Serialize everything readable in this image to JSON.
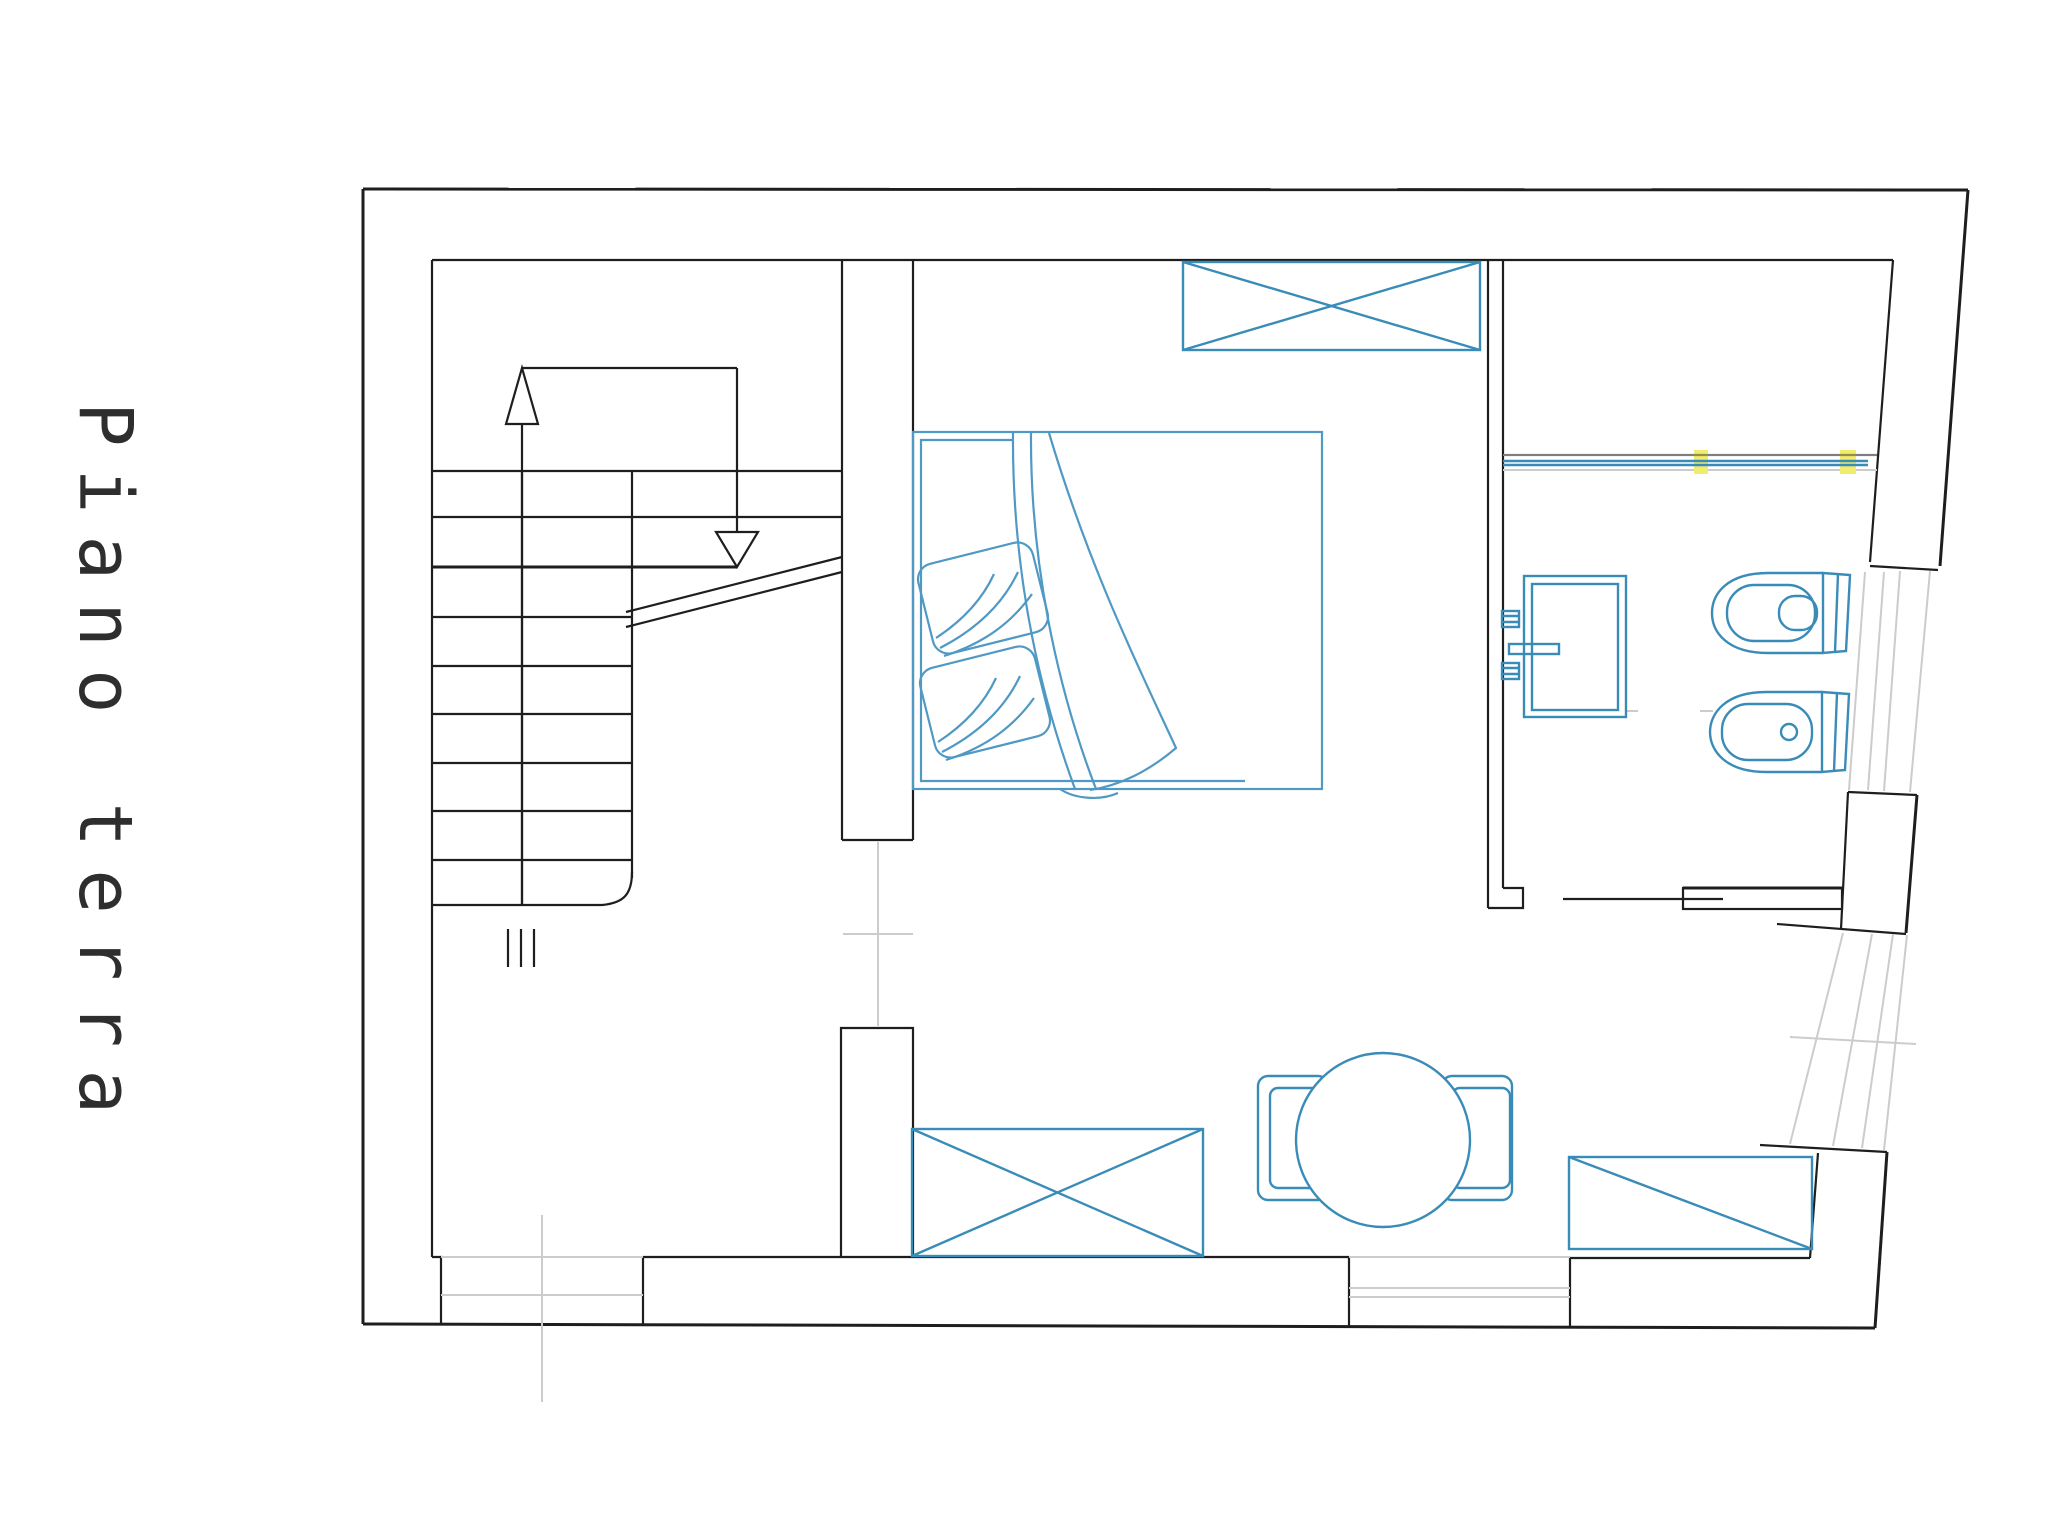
{
  "page": {
    "background": "#ffffff",
    "width": 2048,
    "height": 1536
  },
  "title": {
    "text": "Piano terra"
  },
  "colors": {
    "page-bg": "#ffffff",
    "wall": "#1e1e1e",
    "fixture": "#3a8cb8",
    "bed": "#4f99c4",
    "construction": "#cccccc",
    "highlight": "#f1ec6e",
    "title-text": "#2e2e2e"
  },
  "plan": {
    "floor_label": "Piano terra",
    "rooms": [
      {
        "name": "staircase"
      },
      {
        "name": "bedroom"
      },
      {
        "name": "bathroom"
      },
      {
        "name": "living-area"
      }
    ],
    "symbols": [
      {
        "name": "stair-treads",
        "count": 9
      },
      {
        "name": "stair-direction-arrow",
        "direction": "up-down"
      },
      {
        "name": "stair-break-line"
      },
      {
        "name": "wardrobe-crossed-box"
      },
      {
        "name": "double-bed",
        "pillows": 2
      },
      {
        "name": "towel-rail",
        "highlight_marks": 2
      },
      {
        "name": "washbasin"
      },
      {
        "name": "toilet"
      },
      {
        "name": "bidet"
      },
      {
        "name": "bathroom-door-leaf"
      },
      {
        "name": "round-dining-table",
        "chairs": 2
      },
      {
        "name": "crossed-cabinet"
      },
      {
        "name": "diagonal-sideboard"
      },
      {
        "name": "entrance-opening-marks"
      },
      {
        "name": "window-upper-right"
      },
      {
        "name": "window-lower-right"
      }
    ]
  }
}
